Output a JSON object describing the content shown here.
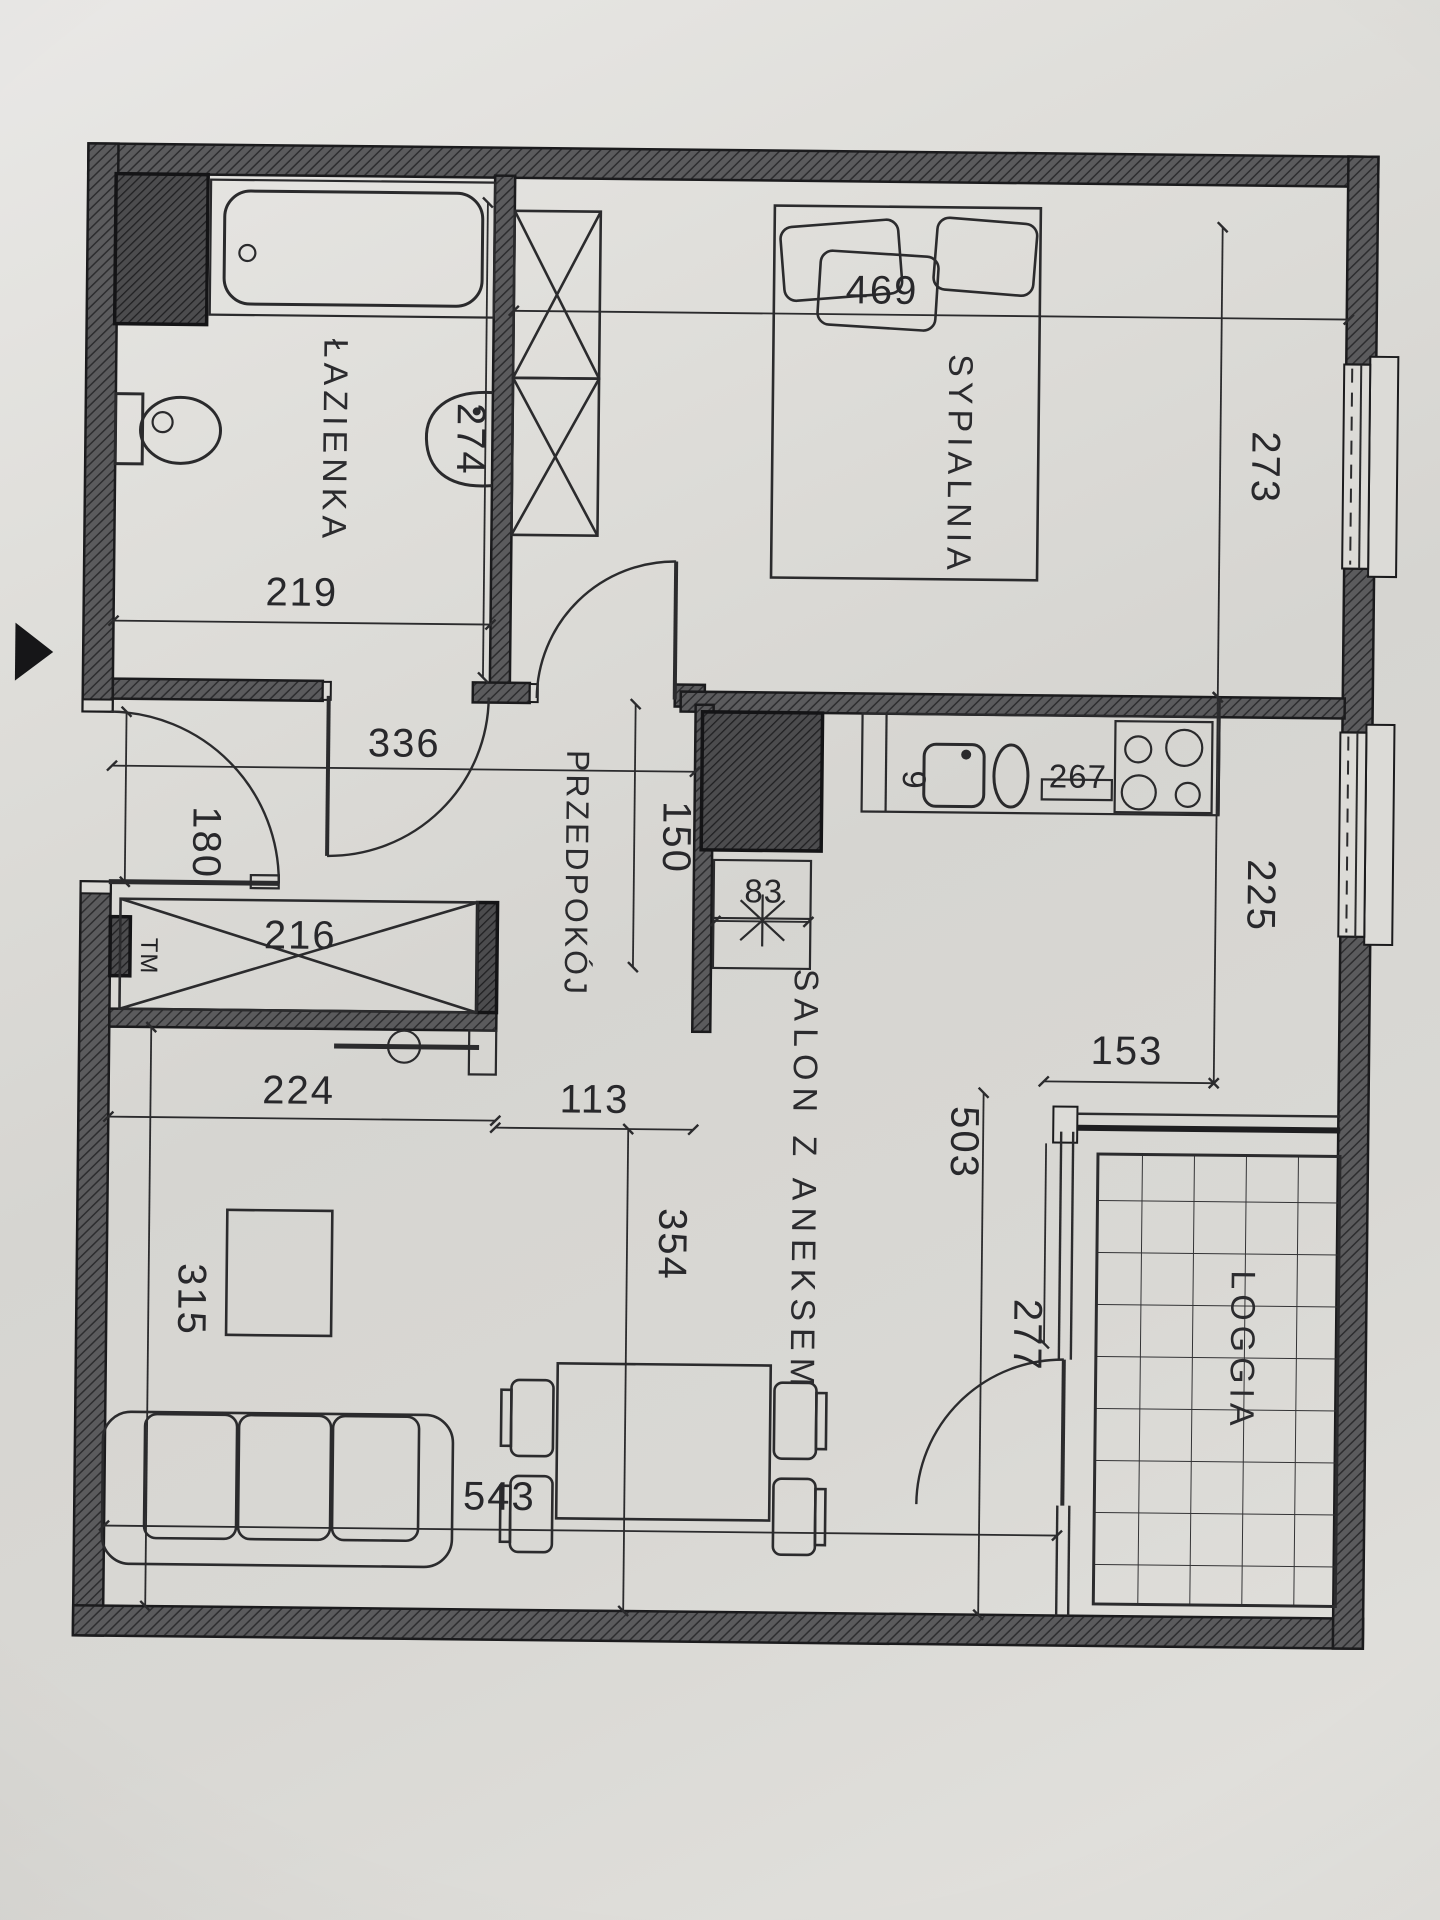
{
  "document": {
    "type": "apartment-floor-plan-scan",
    "language": "pl"
  },
  "rooms": {
    "bathroom": "ŁAZIENKA",
    "bedroom": "SYPIALNIA",
    "hall": "PRZEDPOKÓJ",
    "living": "SALON Z ANEKSEM",
    "loggia": "LOGGIA",
    "meter": "TM"
  },
  "dims": {
    "d469": "469",
    "d273": "273",
    "d274": "274",
    "d219": "219",
    "d336": "336",
    "d150": "150",
    "d180": "180",
    "d216": "216",
    "d224": "224",
    "d113": "113",
    "d83": "83",
    "d267": "267",
    "d9": "9",
    "d225": "225",
    "d153": "153",
    "d503": "503",
    "d277": "277",
    "d315": "315",
    "d354": "354",
    "d543": "543"
  },
  "colors": {
    "paper": "#d9d8d4",
    "line": "#2b2b2d",
    "wall": "#58585a"
  }
}
